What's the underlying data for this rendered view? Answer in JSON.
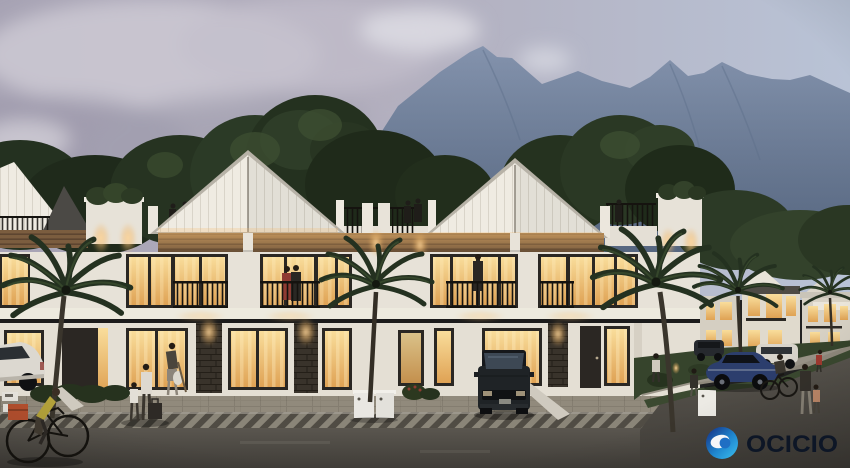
{
  "watermark": {
    "brand_text": "OCICIO",
    "icon": "ocicio-logo-icon"
  },
  "palette": {
    "skyLeft": "#a7a3b4",
    "skyMid": "#b2aebd",
    "skyRight": "#b9c3d6",
    "cloudLight": "#cdc9d4",
    "mountainTop": "#8493ad",
    "mountainBottom": "#697a94",
    "treeDark": "#243120",
    "treeMid": "#3a4c2e",
    "facadeWhite": "#e7e2d8",
    "gableWhite": "#efebe2",
    "woodBrown": "#7b5d3f",
    "woodSlatShadow": "#5d4530",
    "stoneDark": "#39332b",
    "windowGlowTop": "#f9dd9b",
    "windowGlowBottom": "#dfa254",
    "frameDark": "#2a2723",
    "railingDark": "#15130f",
    "paverGray": "#8d8779",
    "paverJoint": "#6f6a5e",
    "chevronLight": "#8a8578",
    "chevronDark": "#504c44",
    "roadTop": "#5a564f",
    "roadBottom": "#403d38",
    "grassGreen": "#3b4930",
    "hedgeGreen": "#26321e",
    "carBlue": "#2c3e6d",
    "suvDark": "#1f2326",
    "accentRed": "#8f3a32",
    "accentYellow": "#b3a23a",
    "logoNavy": "#152a7e",
    "logoBlue": "#1f87cf",
    "logoCyan": "#3cc0ee",
    "logoText": "#0d1626"
  }
}
